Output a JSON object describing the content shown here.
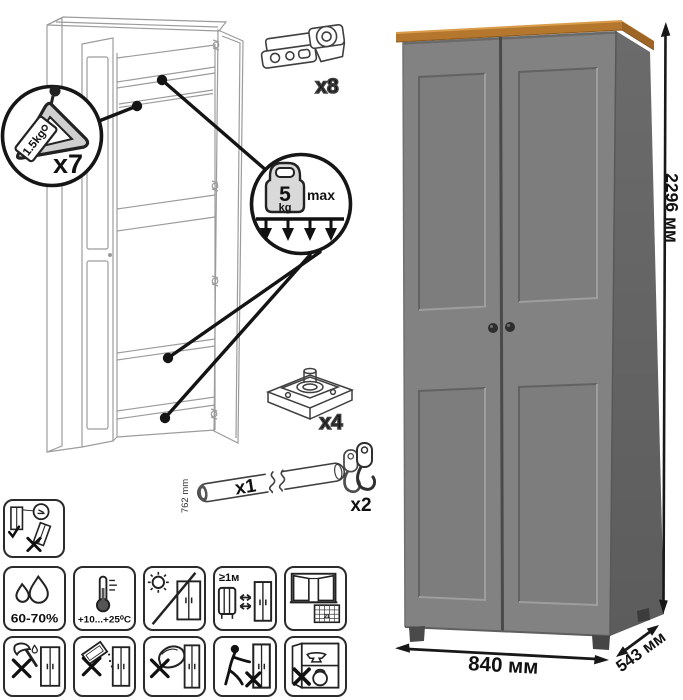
{
  "product": {
    "dimensions": {
      "height": "2296 мм",
      "width": "840 мм",
      "depth": "543 мм"
    },
    "colors": {
      "door_gray": "#828282",
      "side_gray": "#6b6b6b",
      "top_wood": "#b5772e",
      "wood_side": "#9d6526",
      "knob": "#2e2e2e"
    }
  },
  "hardware": {
    "hanger": {
      "count": "x7",
      "tag": "1.5kg"
    },
    "shelf_load": {
      "value": "5",
      "unit": "kg",
      "limit": "max"
    },
    "hinge": {
      "count": "x8"
    },
    "foot": {
      "count": "x4"
    },
    "rod": {
      "count": "x1",
      "length": "762 mm"
    },
    "hook": {
      "count": "x2"
    }
  },
  "care": {
    "humidity": "60-70%",
    "temperature": "+10...+25⁰C",
    "heat_distance": "≥1м",
    "calendar_day": "21",
    "icons": [
      "anti-tip-fix-upright",
      "humidity-range",
      "temperature-range",
      "no-direct-sunlight",
      "keep-1m-from-heaters",
      "ventilate-room",
      "no-sharp-impact",
      "no-abrasive-cleaners",
      "no-wet-sponge",
      "do-not-push",
      "do-not-overload"
    ]
  }
}
